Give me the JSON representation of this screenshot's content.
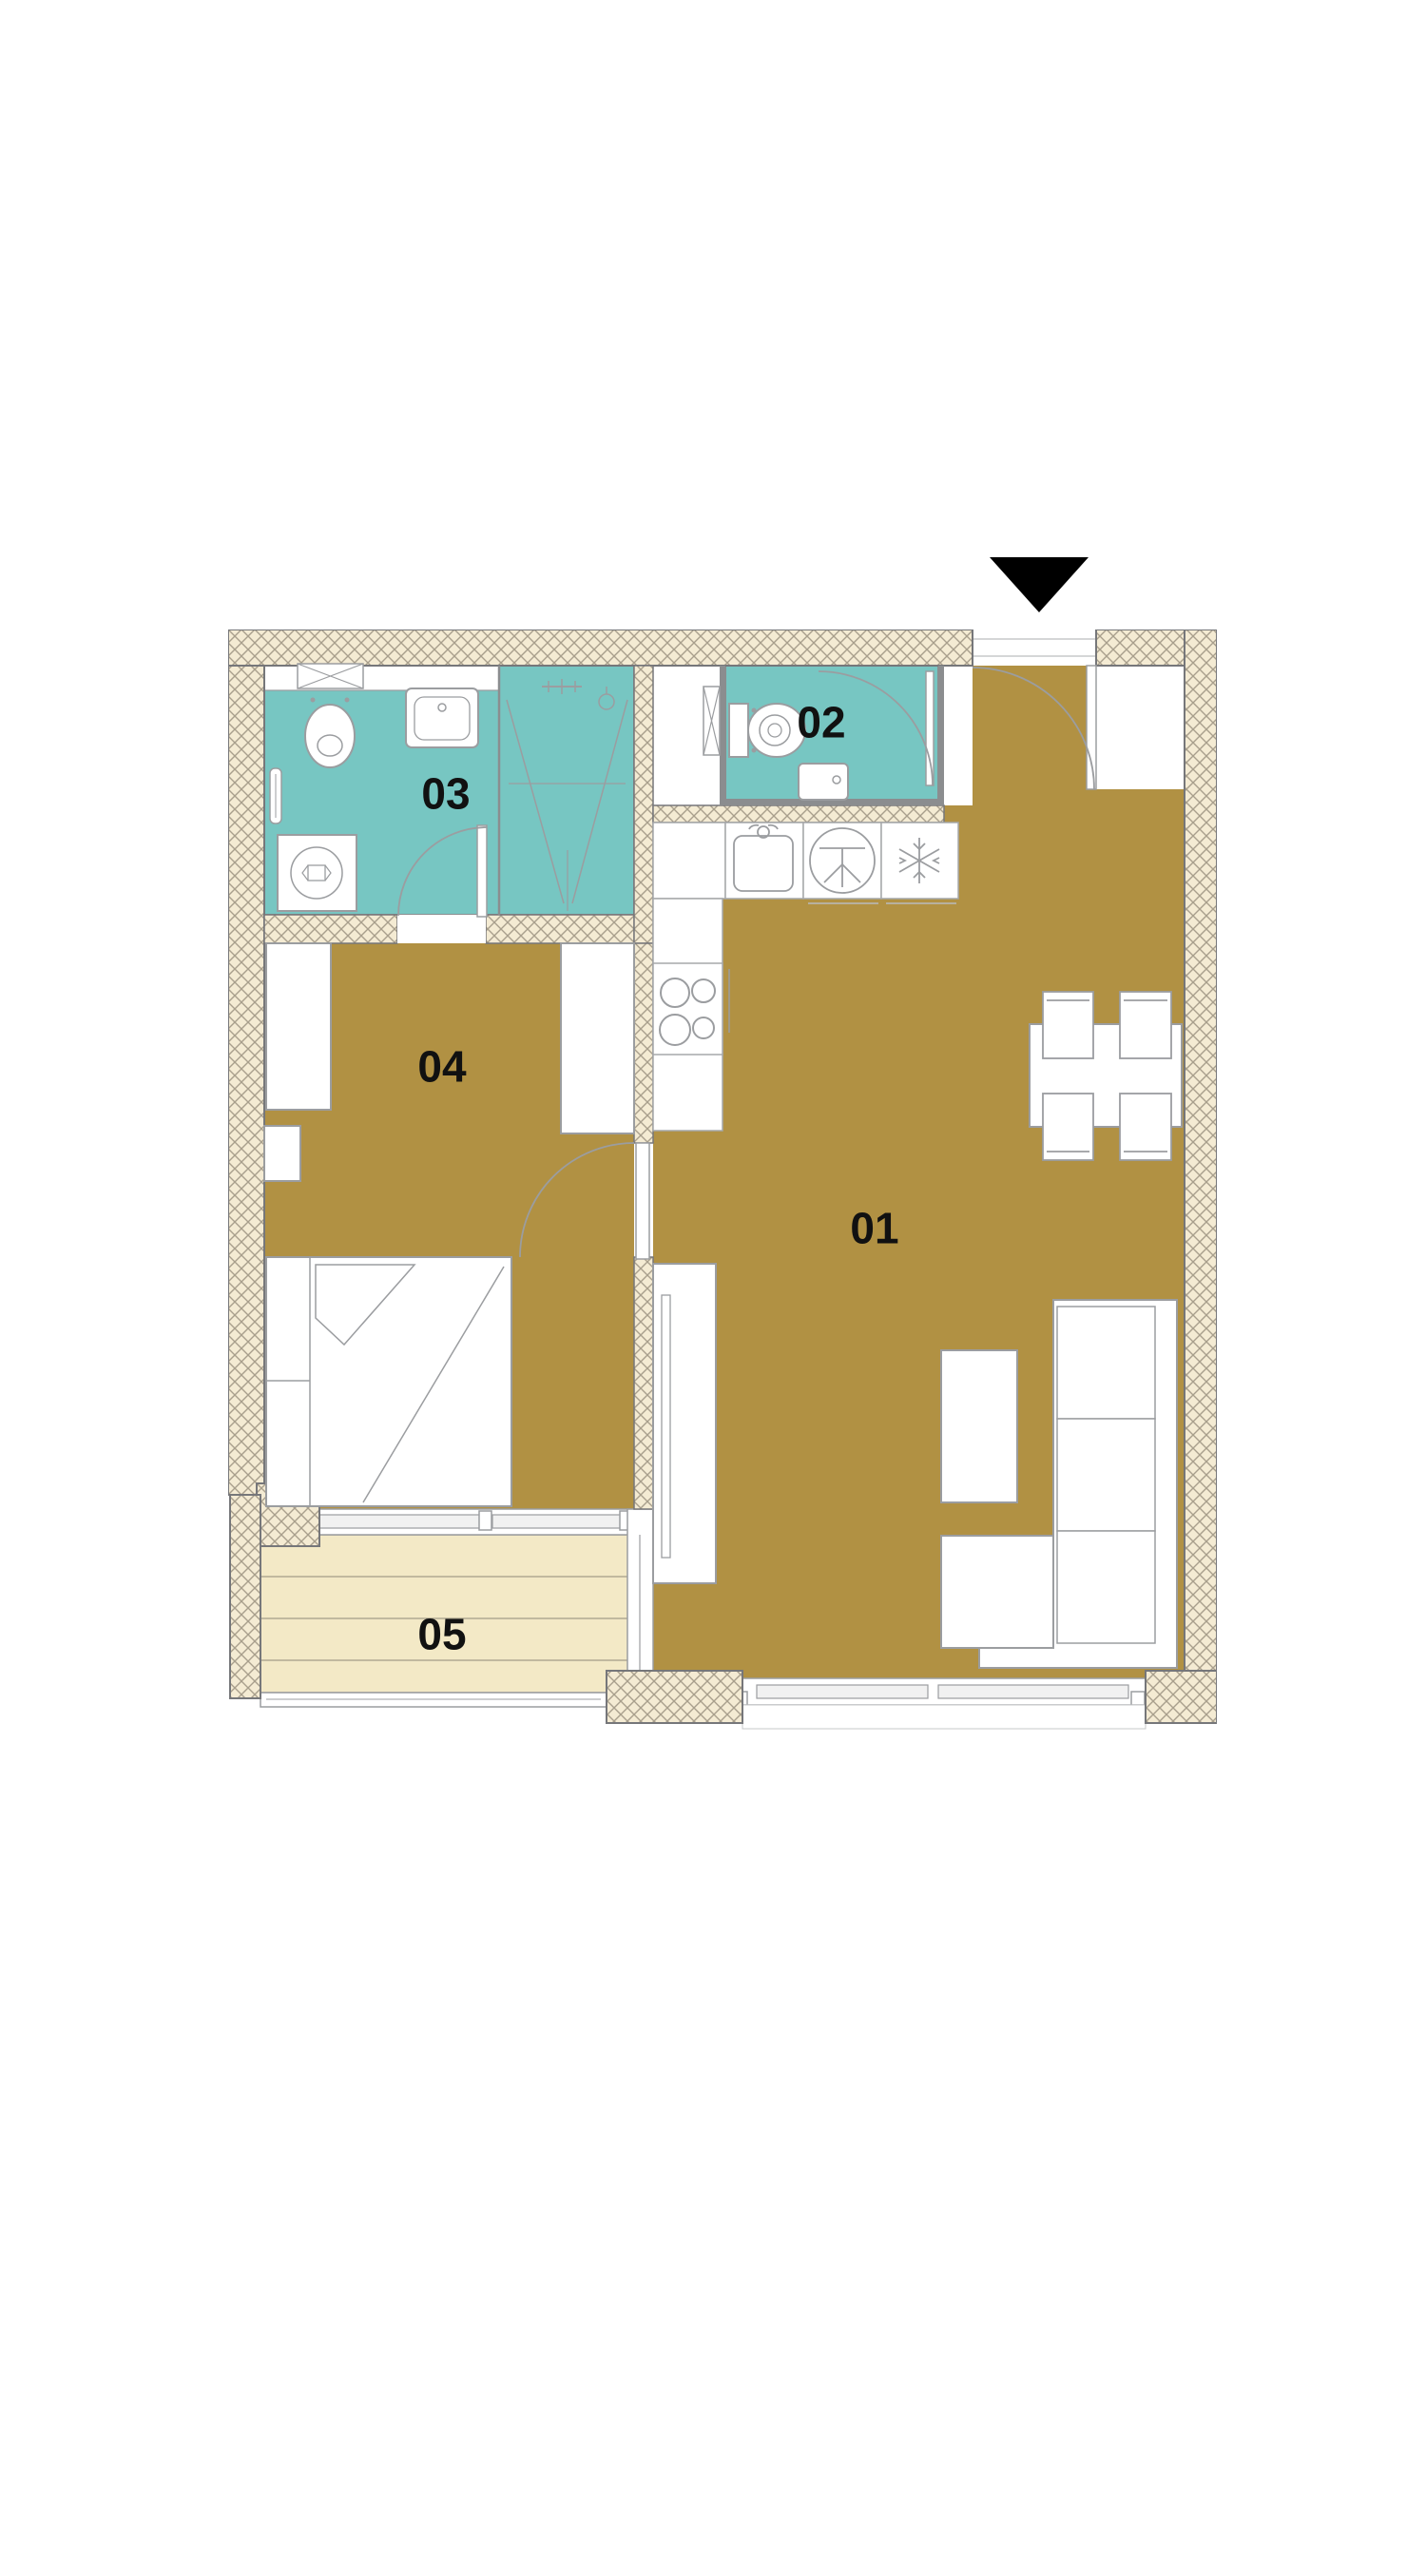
{
  "floor_plan": {
    "rooms": [
      {
        "label": "01"
      },
      {
        "label": "02"
      },
      {
        "label": "03"
      },
      {
        "label": "04"
      },
      {
        "label": "05"
      }
    ],
    "entrance_marker": {
      "icon": "down-triangle"
    },
    "colors": {
      "floor": "#b19143",
      "wet_room": "#77c6c2",
      "wall_fill": "#f4ebd3",
      "wall_hatch_line": "#a89f8c",
      "wall_outline": "#76777a",
      "partition": "#8b8d8f",
      "balcony_deck": "#f3e9c6",
      "furniture_line": "#9b9da0",
      "label_text": "#111111",
      "arrow": "#000000"
    },
    "icons": [
      "entrance-arrow-icon",
      "toilet-icon",
      "sink-icon",
      "shower-icon",
      "washing-machine-icon",
      "vent-shaft-icon",
      "kitchen-sink-icon",
      "dishwasher-icon",
      "fridge-snowflake-icon",
      "stove-burners-icon"
    ]
  }
}
